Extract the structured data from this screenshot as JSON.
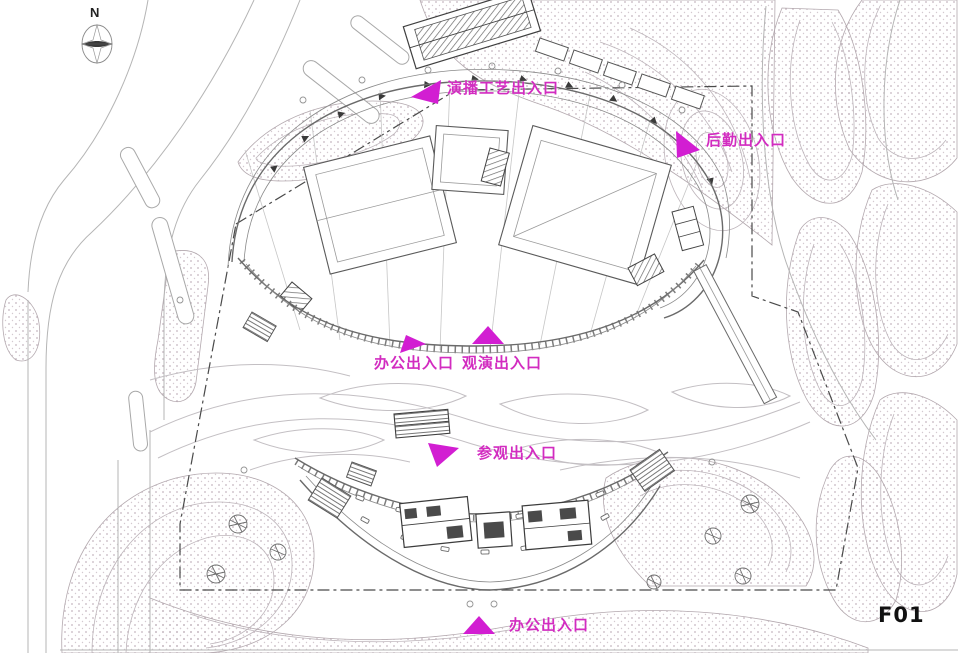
{
  "page": {
    "floor_code": "F01"
  },
  "compass": {
    "label": "N"
  },
  "annotations": [
    {
      "id": "broadcast-entrance",
      "text": "演播工艺出入口"
    },
    {
      "id": "logistics-entrance",
      "text": "后勤出入口"
    },
    {
      "id": "office-entrance-mid",
      "text": "办公出入口"
    },
    {
      "id": "audience-entrance",
      "text": "观演出入口"
    },
    {
      "id": "visitor-entrance",
      "text": "参观出入口"
    },
    {
      "id": "office-entrance-bottom",
      "text": "办公出入口"
    }
  ],
  "colors": {
    "annotation_text": "#d22cc0",
    "arrow": "#d21ed2",
    "floor_label": "#111111",
    "drawing_light": "#b9b2b6",
    "drawing_dark": "#555555"
  }
}
